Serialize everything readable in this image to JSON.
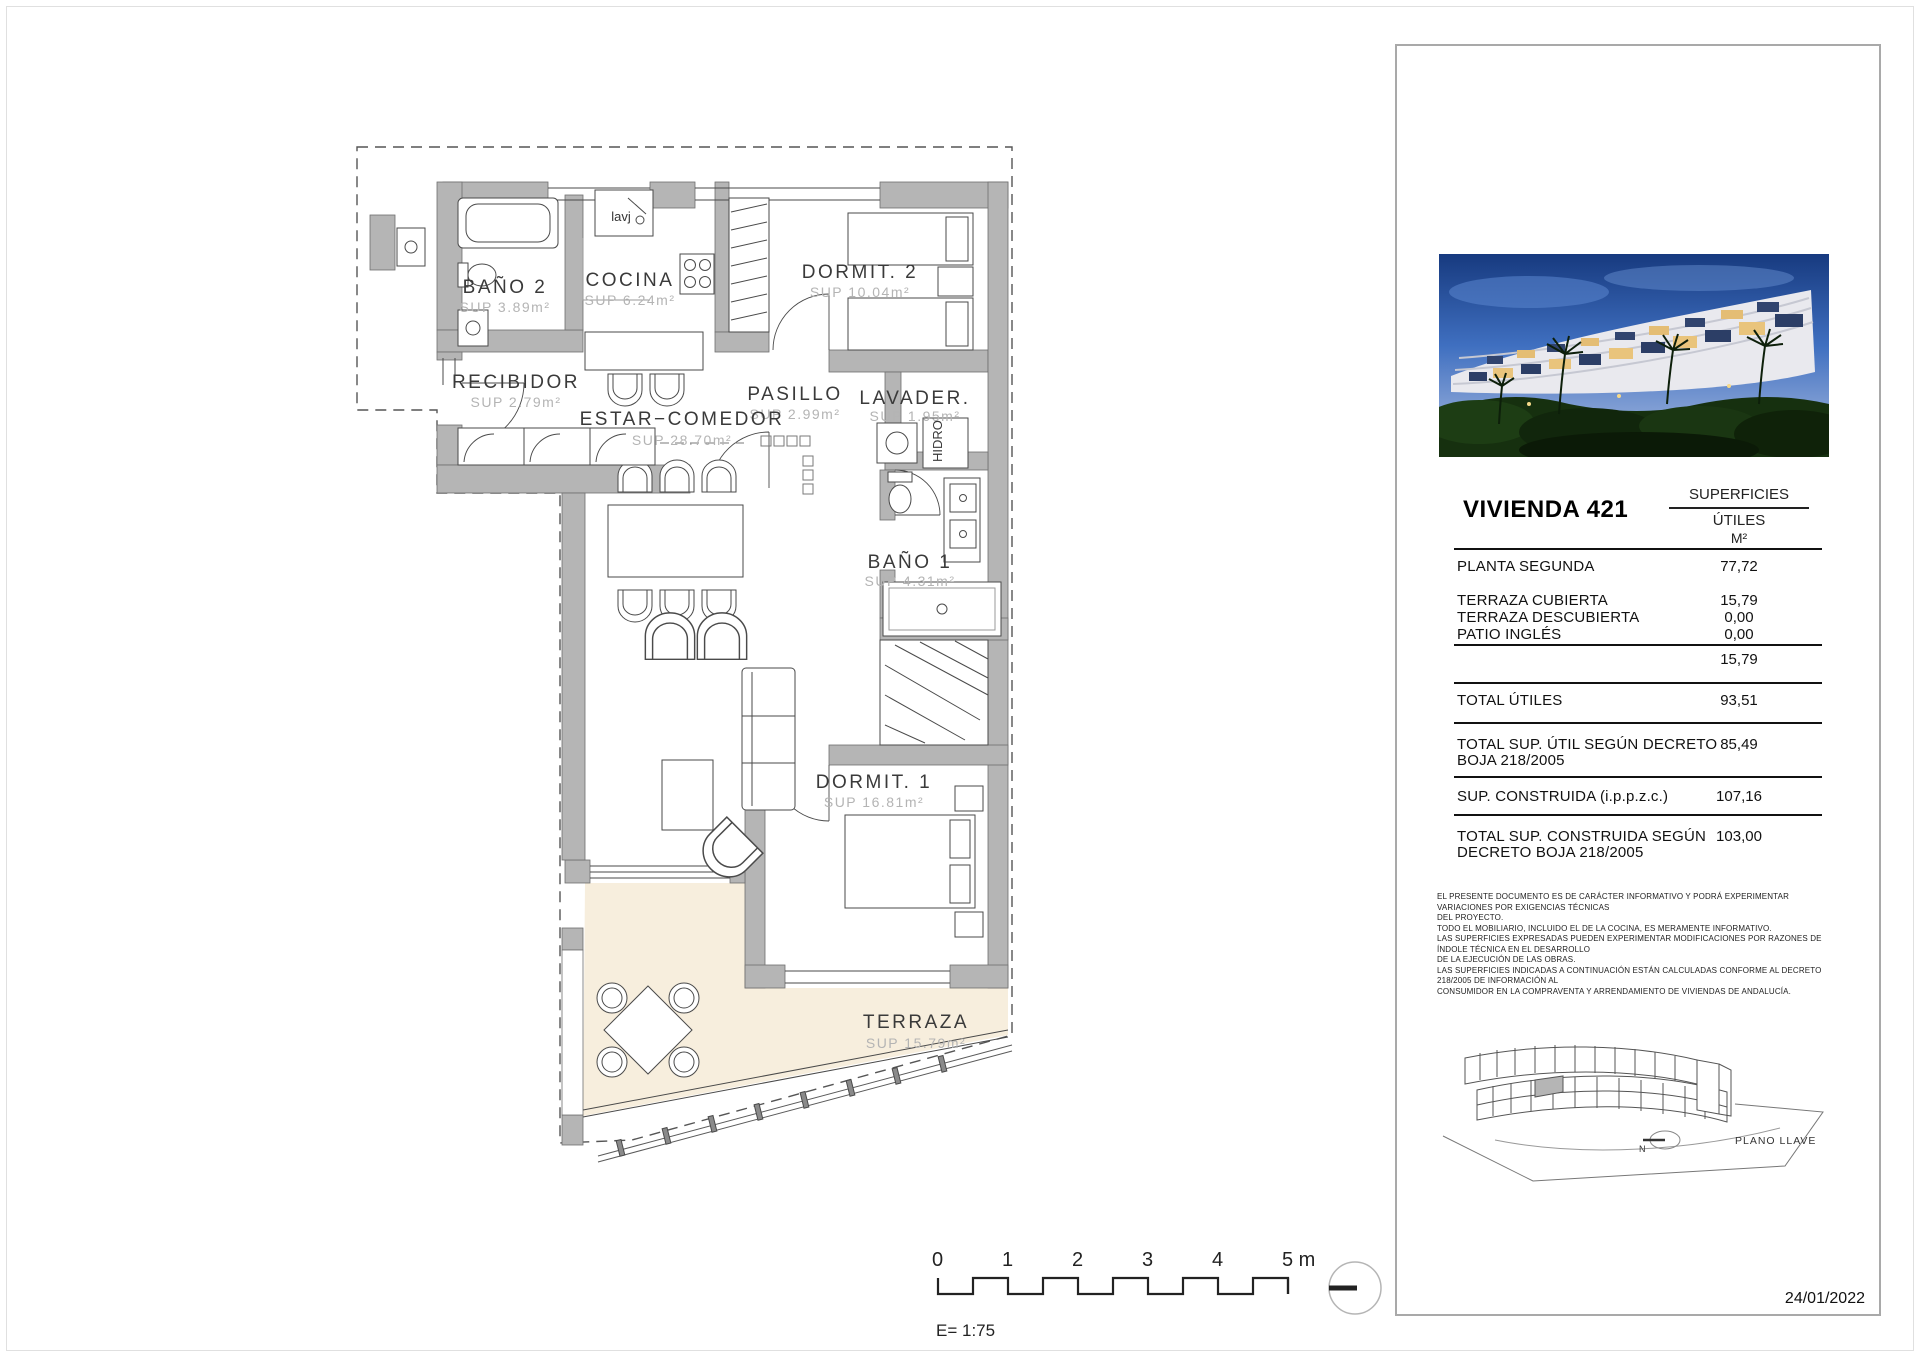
{
  "plan": {
    "rooms": {
      "bano2": {
        "name": "BAÑO 2",
        "sup": "SUP 3.89m²"
      },
      "cocina": {
        "name": "COCINA",
        "sup": "SUP 6.24m²"
      },
      "dormit2": {
        "name": "DORMIT. 2",
        "sup": "SUP 10.04m²"
      },
      "recibidor": {
        "name": "RECIBIDOR",
        "sup": "SUP 2.79m²"
      },
      "pasillo": {
        "name": "PASILLO",
        "sup": "SUP 2.99m²"
      },
      "lavadero": {
        "name": "LAVADER.",
        "sup": "SUP 1.95m²"
      },
      "estar": {
        "name": "ESTAR−COMEDOR",
        "sup": "SUP 28.70m²"
      },
      "bano1": {
        "name": "BAÑO 1",
        "sup": "SUP 4.31m²"
      },
      "dormit1": {
        "name": "DORMIT. 1",
        "sup": "SUP 16.81m²"
      },
      "terraza": {
        "name": "TERRAZA",
        "sup": "SUP 15.79m²"
      }
    },
    "annotations": {
      "lavj": "lavj",
      "hidro": "HIDRO"
    },
    "colors": {
      "wall": "#b5b5b5",
      "terrace": "#f7eedd",
      "line": "#4a4a4a"
    }
  },
  "scale": {
    "ticks": [
      "0",
      "1",
      "2",
      "3",
      "4",
      "5 m"
    ],
    "label": "E= 1:75"
  },
  "panel": {
    "title": "VIVIENDA 421",
    "table": {
      "col_header": "SUPERFICIES",
      "col_sub": "ÚTILES",
      "col_unit": "M²",
      "planta_segunda": {
        "label": "PLANTA SEGUNDA",
        "value": "77,72"
      },
      "terraza_cubierta": {
        "label": "TERRAZA CUBIERTA",
        "value": "15,79"
      },
      "terraza_descubierta": {
        "label": "TERRAZA DESCUBIERTA",
        "value": "0,00"
      },
      "patio_ingles": {
        "label": "PATIO INGLÉS",
        "value": "0,00"
      },
      "subtotal": {
        "value": "15,79"
      },
      "total_utiles": {
        "label": "TOTAL ÚTILES",
        "value": "93,51"
      },
      "total_util_decreto": {
        "label": "TOTAL SUP. ÚTIL SEGÚN DECRETO",
        "label2": "BOJA 218/2005",
        "value": "85,49"
      },
      "sup_construida": {
        "label": "SUP. CONSTRUIDA (i.p.p.z.c.)",
        "value": "107,16"
      },
      "total_construida": {
        "label": "TOTAL SUP. CONSTRUIDA SEGÚN",
        "label2": "DECRETO BOJA 218/2005",
        "value": "103,00"
      }
    },
    "disclaimer": [
      "EL PRESENTE DOCUMENTO ES DE CARÁCTER INFORMATIVO Y PODRÁ EXPERIMENTAR VARIACIONES POR EXIGENCIAS TÉCNICAS",
      "DEL PROYECTO.",
      "TODO EL MOBILIARIO, INCLUIDO EL DE LA COCINA, ES MERAMENTE INFORMATIVO.",
      "LAS SUPERFICIES EXPRESADAS PUEDEN EXPERIMENTAR MODIFICACIONES POR RAZONES DE ÍNDOLE TÉCNICA EN EL DESARROLLO",
      "DE LA EJECUCIÓN DE LAS OBRAS.",
      "LAS SUPERFICIES INDICADAS A CONTINUACIÓN ESTÁN CALCULADAS CONFORME AL DECRETO 218/2005 DE INFORMACIÓN AL",
      "CONSUMIDOR EN LA COMPRAVENTA Y ARRENDAMIENTO DE VIVIENDAS DE ANDALUCÍA."
    ],
    "key_plan": {
      "label": "PLANO LLAVE",
      "north": "N"
    },
    "date": "24/01/2022"
  }
}
